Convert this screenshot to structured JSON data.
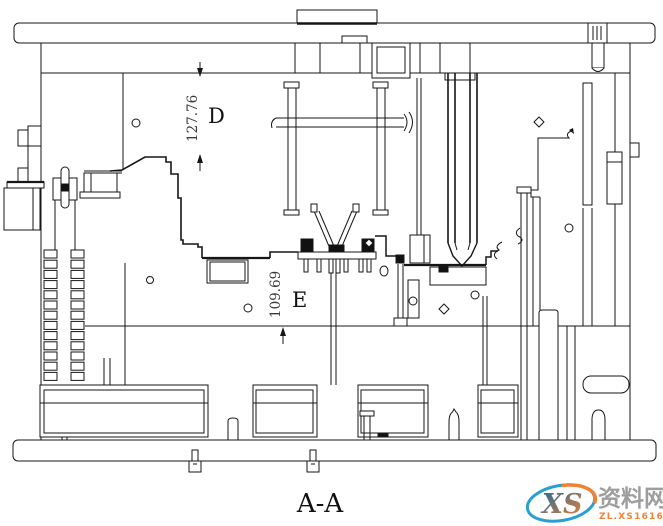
{
  "drawing": {
    "view_label": "A-A",
    "type": "mold-assembly-section",
    "line_color": "#161616",
    "background": "#ffffff",
    "dimensions": [
      {
        "id": "D",
        "value": "127.76",
        "label": "D"
      },
      {
        "id": "E",
        "value": "109.69",
        "label": "E"
      }
    ]
  },
  "watermark": {
    "logo_text": "XS",
    "site_name": "资料网",
    "site_url": "ZL.XS1616.COM",
    "color_blue": "#2b9fd4",
    "color_orange": "#f08233",
    "color_gray": "#9e9e9e"
  }
}
